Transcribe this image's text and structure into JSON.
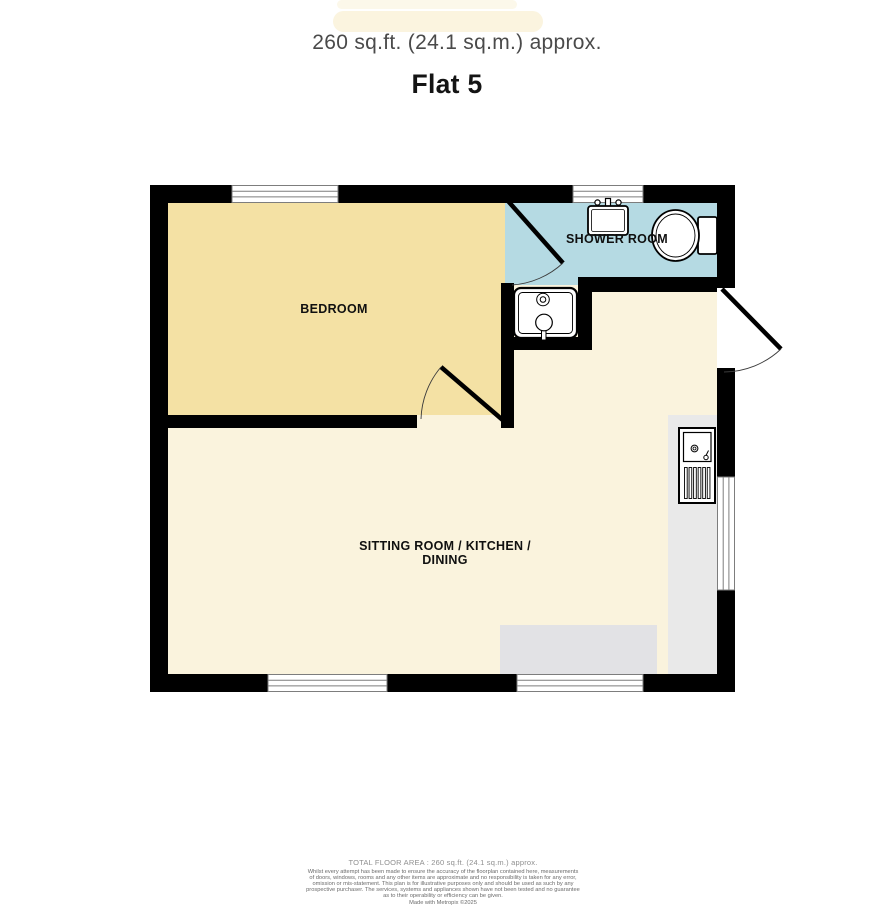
{
  "header": {
    "area_approx": "260 sq.ft. (24.1 sq.m.) approx.",
    "title": "Flat 5"
  },
  "rooms": {
    "bedroom": {
      "label": "BEDROOM"
    },
    "shower": {
      "label": "SHOWER ROOM"
    },
    "living": {
      "label_line1": "SITTING ROOM / KITCHEN /",
      "label_line2": "DINING"
    }
  },
  "fixtures": {
    "basin": "wash-basin",
    "toilet": "toilet",
    "shower_tray": "shower",
    "kitchen_sink": "kitchen-sink-drainer"
  },
  "footer": {
    "total_area": "TOTAL FLOOR AREA : 260 sq.ft. (24.1 sq.m.) approx.",
    "disclaimer_lines": [
      "Whilst every attempt has been made to ensure the accuracy of the floorplan contained here, measurements",
      "of doors, windows, rooms and any other items are approximate and no responsibility is taken for any error,",
      "omission or mis-statement. This plan is for illustrative purposes only and should be used as such by any",
      "prospective purchaser. The services, systems and appliances shown have not been tested and no guarantee",
      "as to their operability or efficiency can be given."
    ],
    "made_with": "Made with Metropix ©2025"
  },
  "colors": {
    "wall": "#000000",
    "bedroom_fill": "#F4E1A4",
    "shower_fill": "#B5DAE3",
    "living_fill": "#FAF3DD",
    "counter_fill": "#E9E9E9",
    "rug_fill": "#E2E2E5",
    "highlight": "#FBF4DF"
  }
}
